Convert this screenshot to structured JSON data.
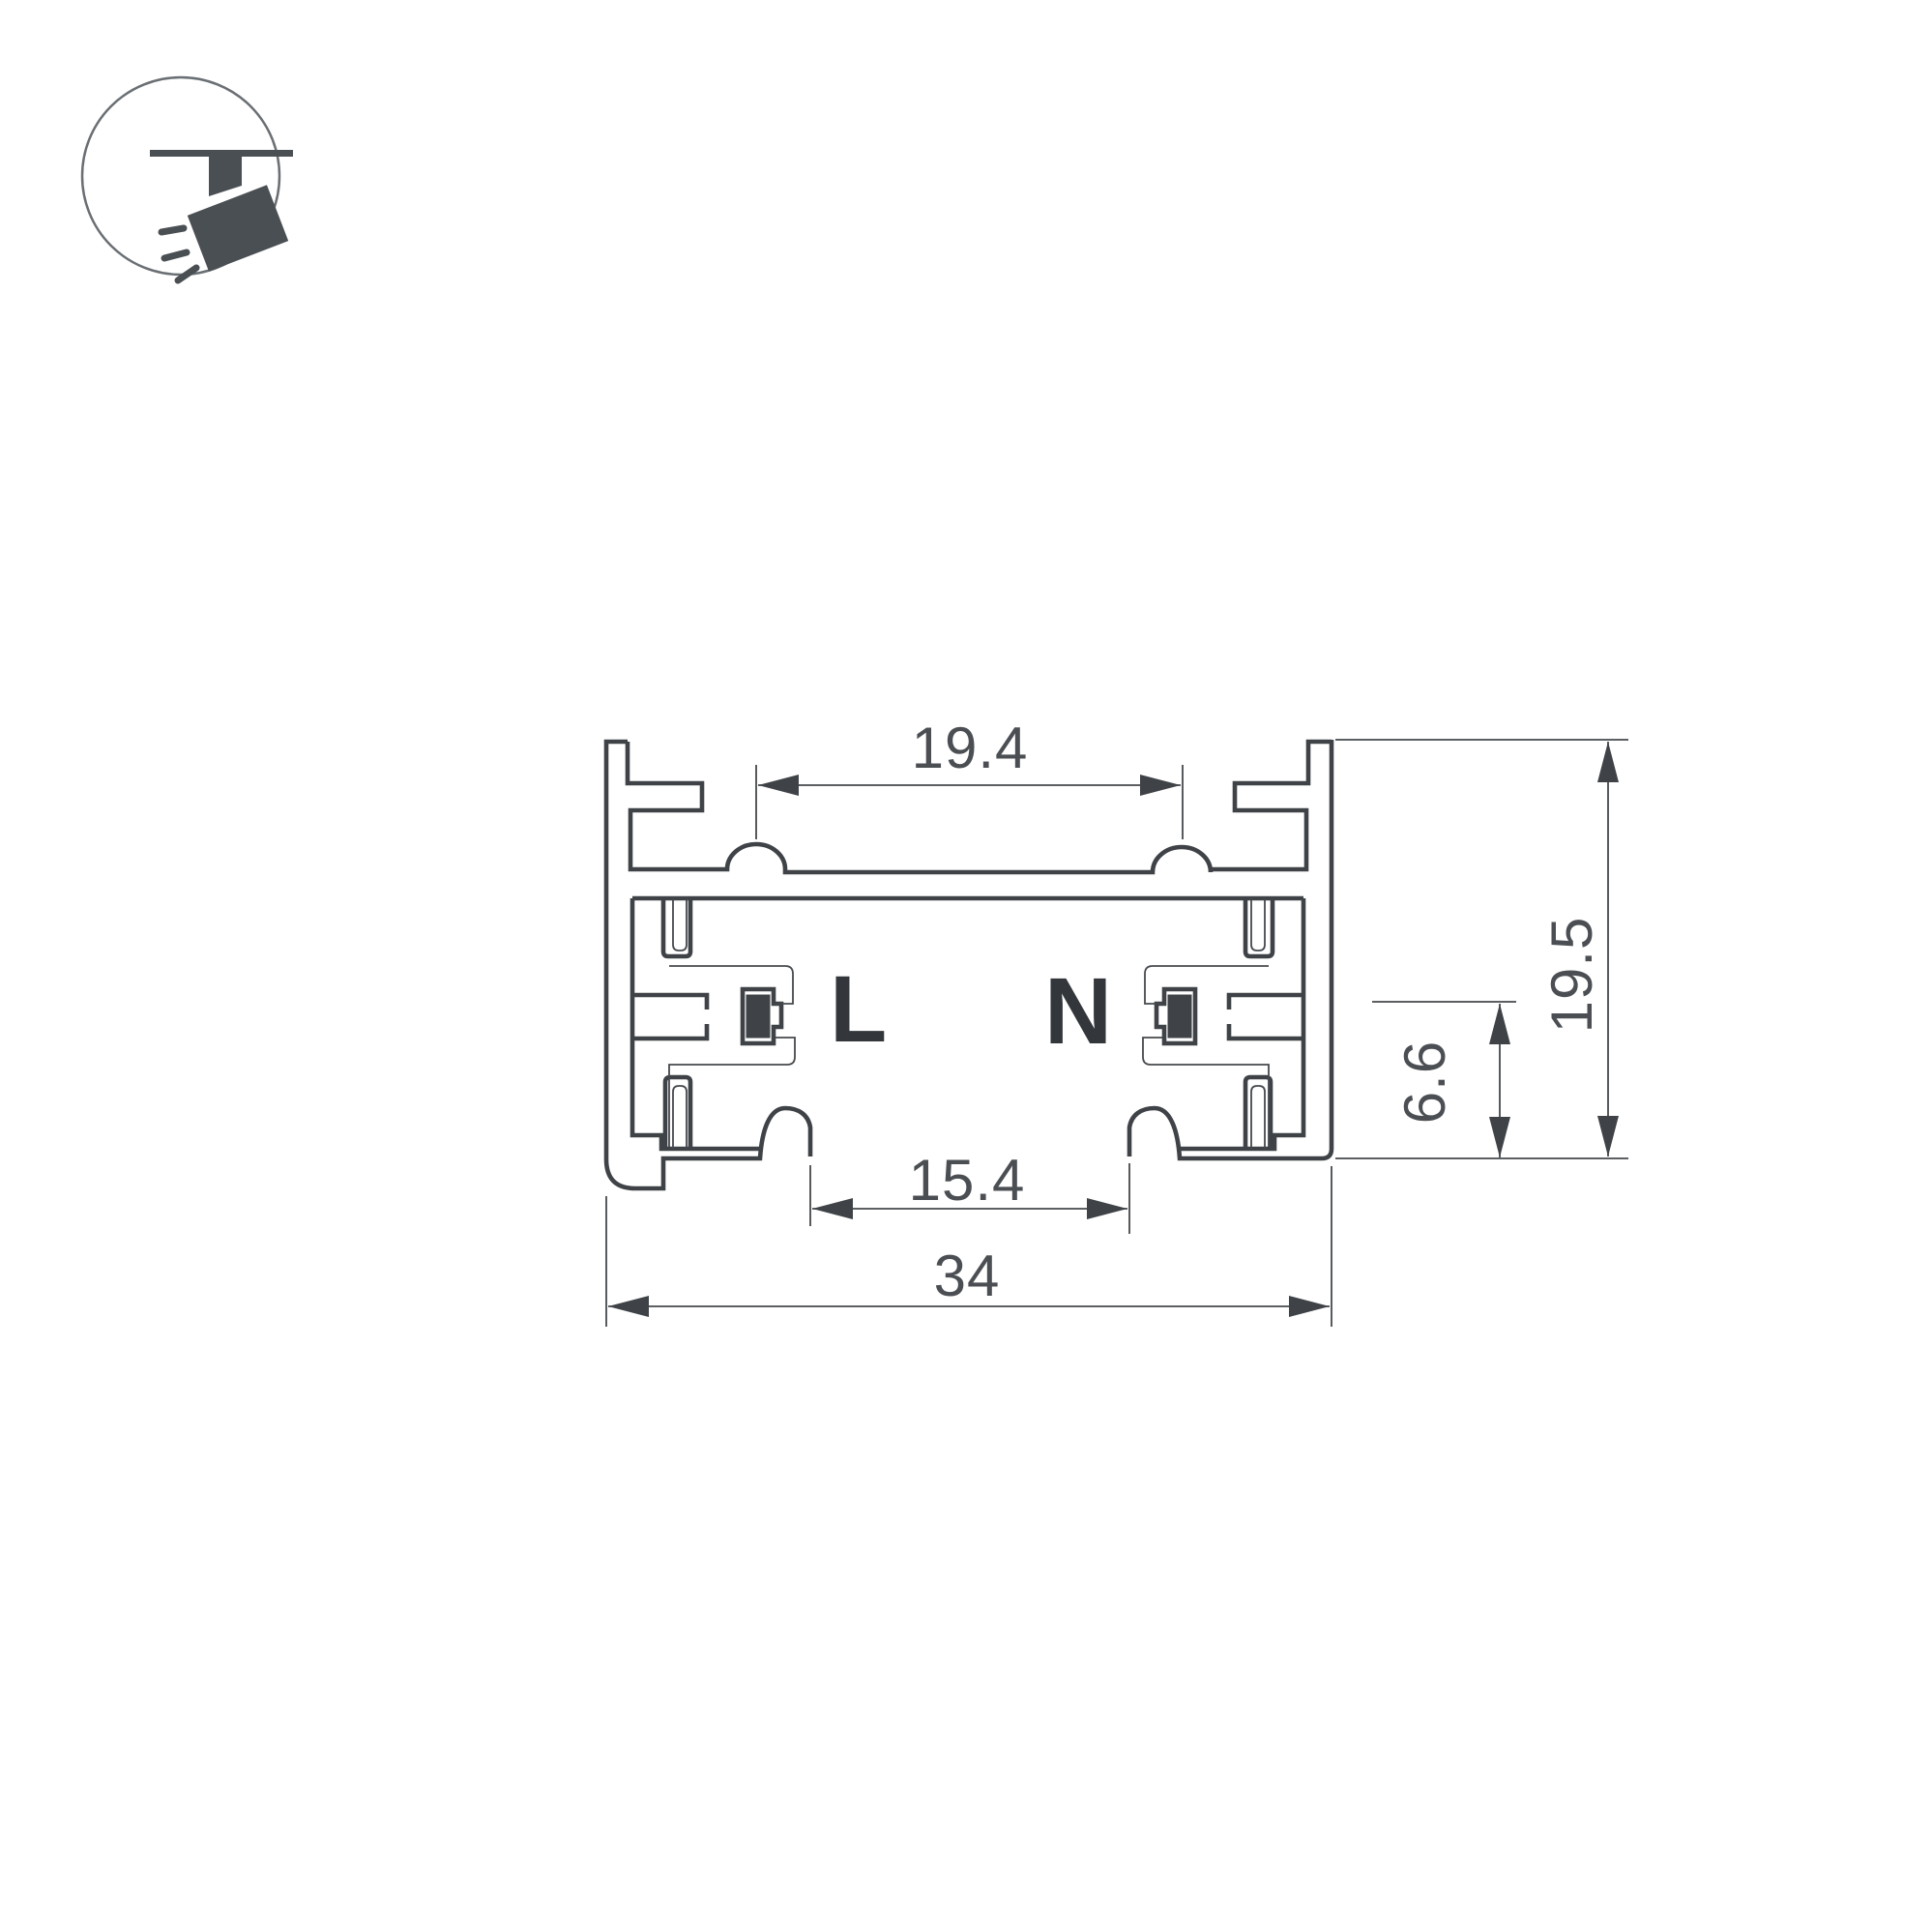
{
  "page": {
    "background": "#ffffff",
    "kind": "technical cross-section drawing of lighting track profile"
  },
  "icon": {
    "name": "track-spotlight-icon",
    "glyph_color": "#4a4f54",
    "ring_color": "#6a6f74"
  },
  "drawing": {
    "line_color": "#3f4347",
    "text_color": "#4b4f53",
    "conductor_fill": "#3f4347",
    "labels": {
      "live": "L",
      "neutral": "N"
    },
    "dimensions": {
      "top_groove_width": "19.4",
      "overall_height": "19.5",
      "contact_height": "6.6",
      "opening_width": "15.4",
      "overall_width": "34"
    }
  }
}
